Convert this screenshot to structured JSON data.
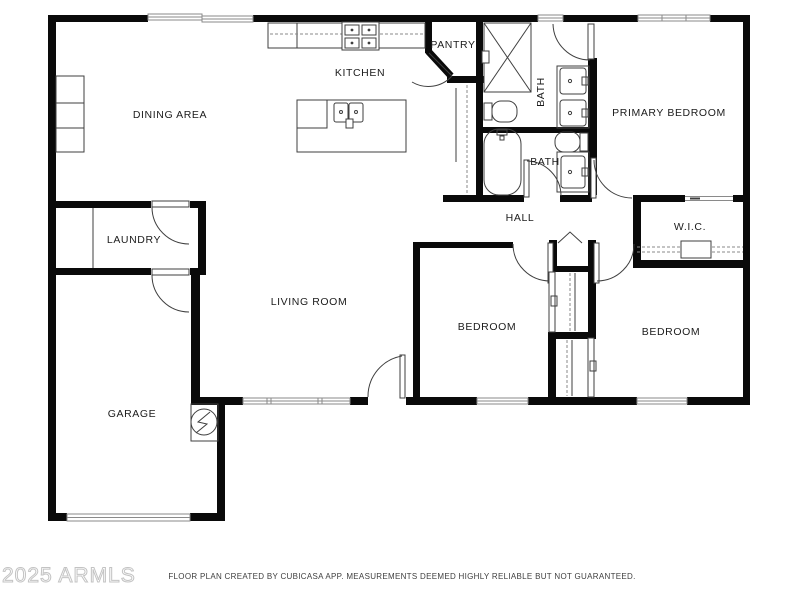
{
  "document": {
    "type": "floor-plan"
  },
  "rooms": [
    {
      "id": "kitchen",
      "label": "KITCHEN"
    },
    {
      "id": "dining-area",
      "label": "DINING AREA"
    },
    {
      "id": "pantry",
      "label": "PANTRY"
    },
    {
      "id": "bath-primary",
      "label": "BATH"
    },
    {
      "id": "primary-bedroom",
      "label": "PRIMARY BEDROOM"
    },
    {
      "id": "bath-hall",
      "label": "BATH"
    },
    {
      "id": "laundry",
      "label": "LAUNDRY"
    },
    {
      "id": "hall",
      "label": "HALL"
    },
    {
      "id": "wic",
      "label": "W.I.C."
    },
    {
      "id": "living-room",
      "label": "LIVING ROOM"
    },
    {
      "id": "bedroom-middle",
      "label": "BEDROOM"
    },
    {
      "id": "bedroom-right",
      "label": "BEDROOM"
    },
    {
      "id": "garage",
      "label": "GARAGE"
    }
  ],
  "footer": {
    "disclaimer": "FLOOR PLAN CREATED BY CUBICASA APP. MEASUREMENTS DEEMED HIGHLY RELIABLE BUT NOT GUARANTEED."
  },
  "watermark": {
    "text": "2025 ARMLS"
  },
  "icons": [
    "stove-icon",
    "kitchen-sink-icon",
    "shower-icon",
    "toilet-icon",
    "bathtub-icon",
    "vanity-sink-icon",
    "water-heater-icon",
    "attic-chevron-icon",
    "closet-rod",
    "garage-door",
    "window",
    "door-arc"
  ],
  "colors": {
    "wall": "#0a0a0a",
    "line": "#3f3f3f",
    "thin": "#8a8a8a",
    "label": "#1c1c1c"
  }
}
